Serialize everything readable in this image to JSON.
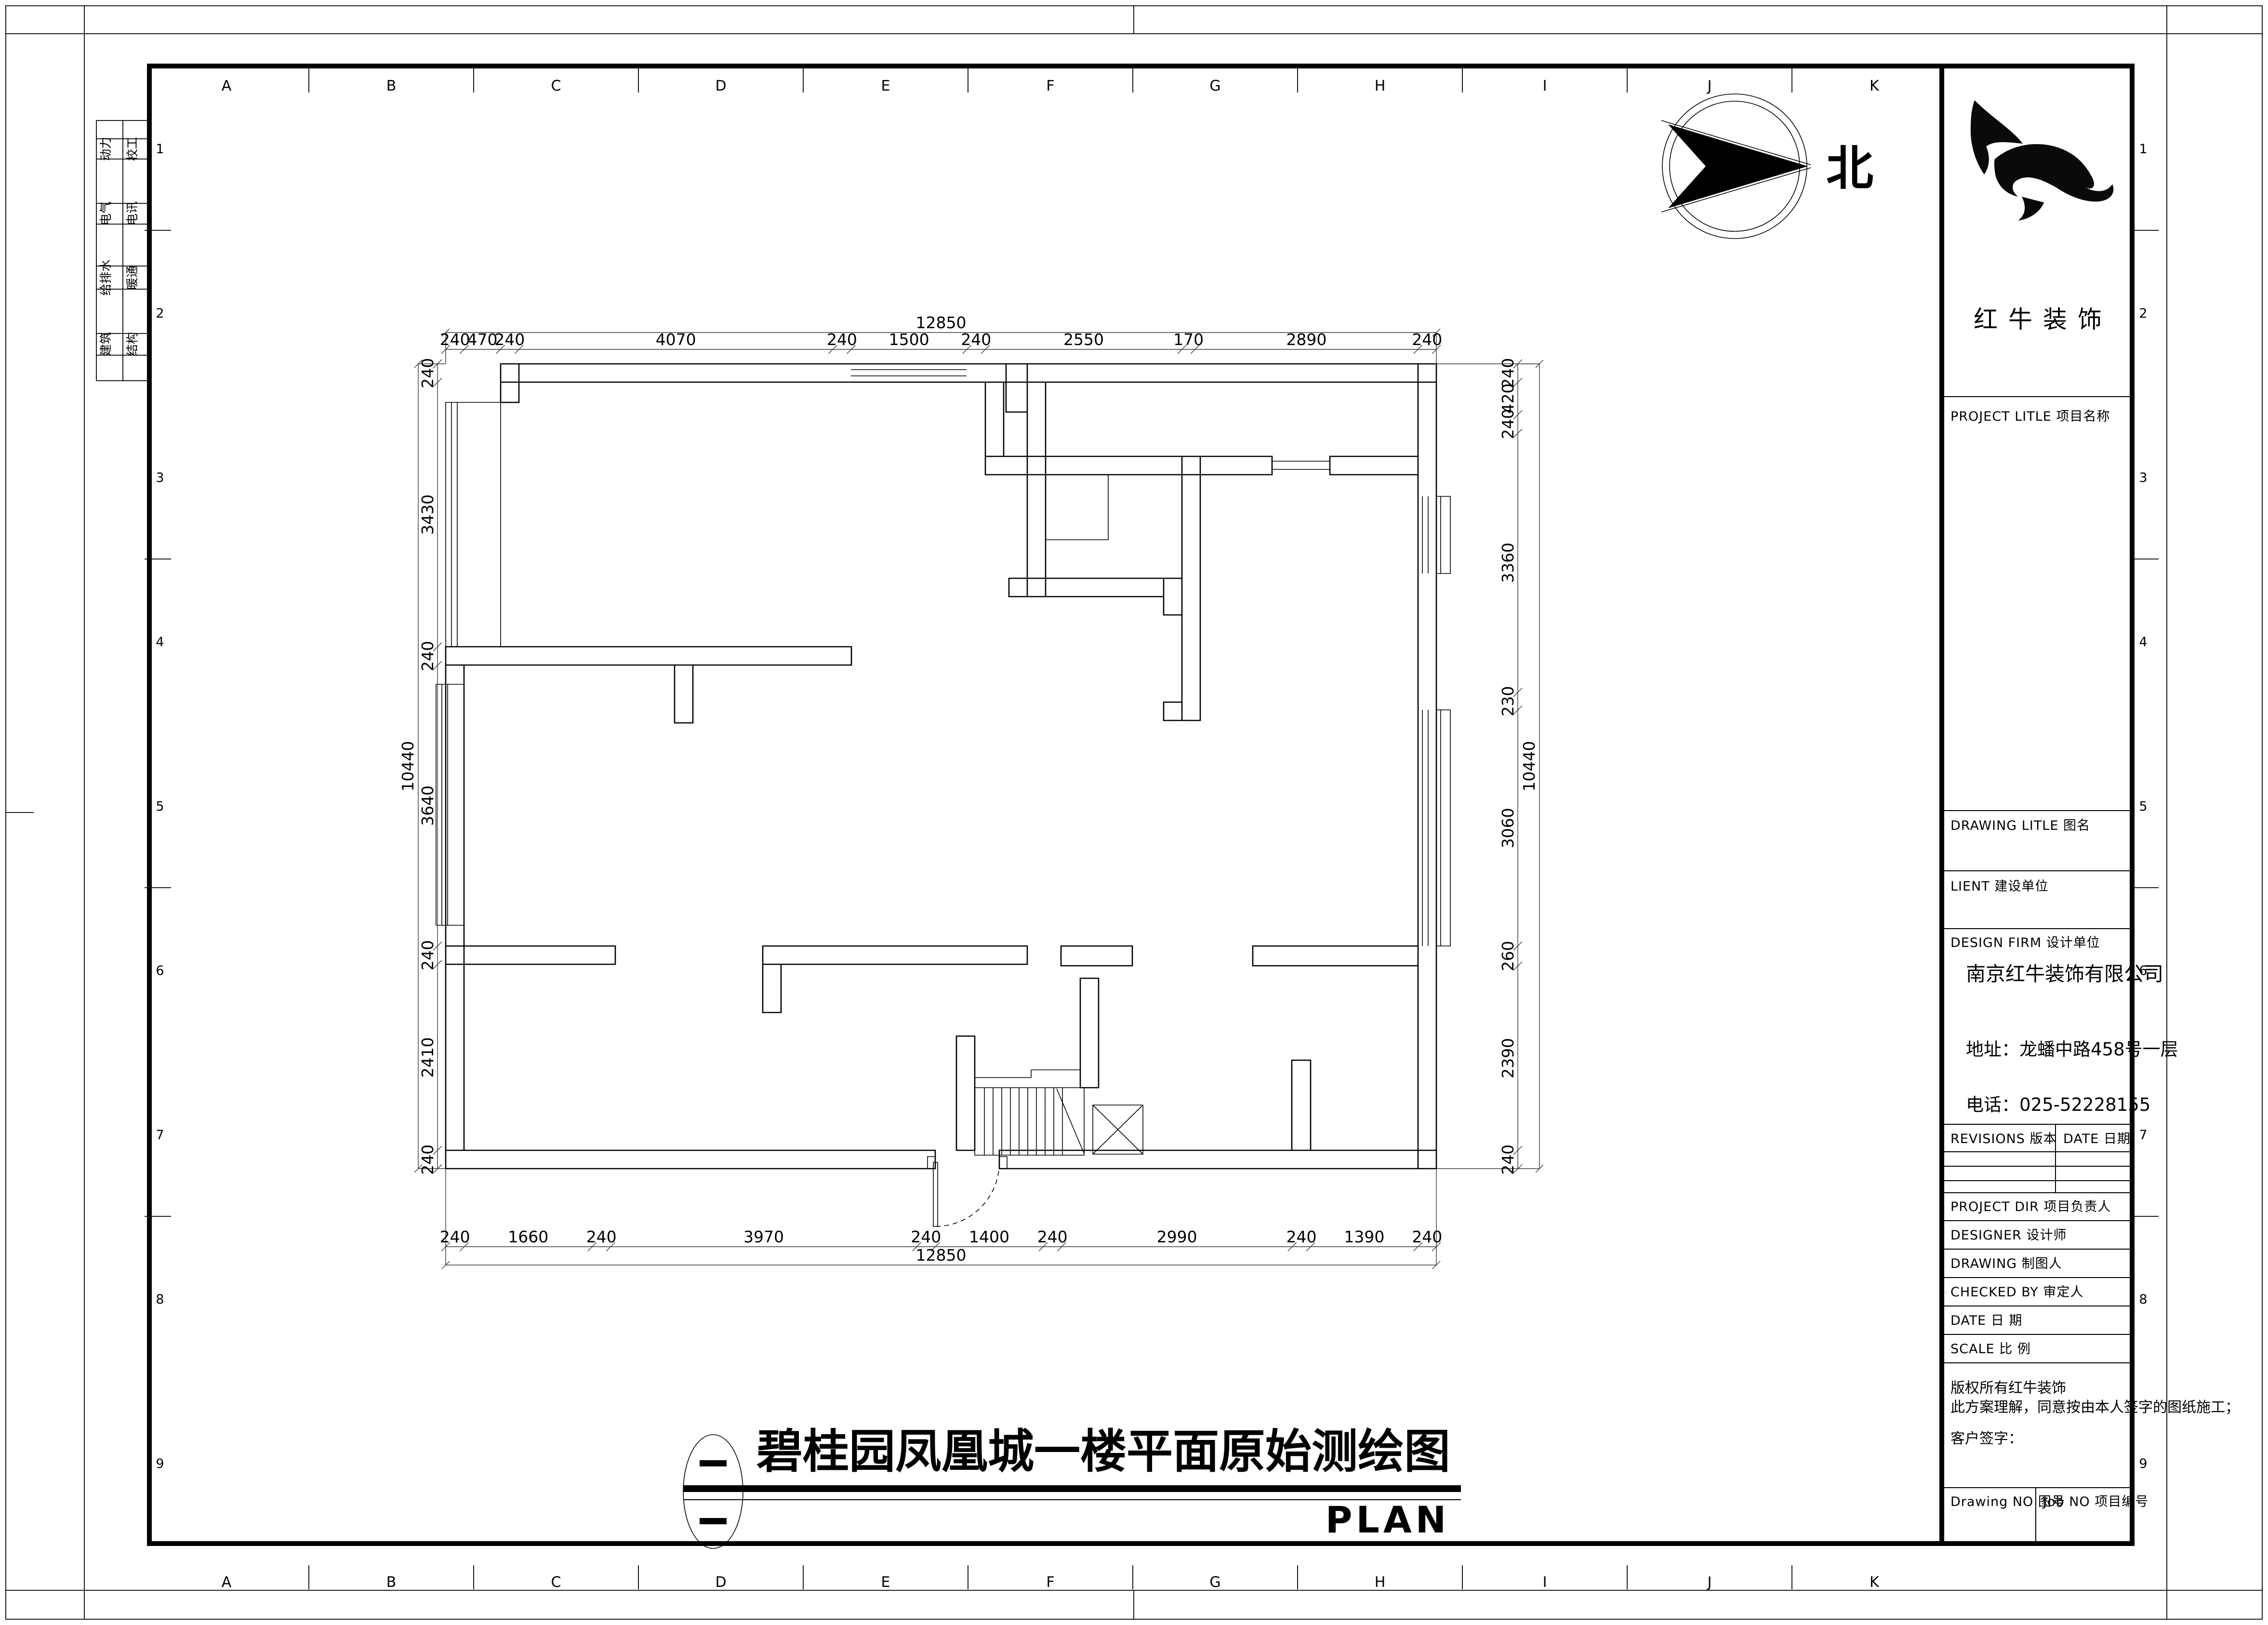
{
  "sheet": {
    "bg": "#ffffff",
    "line_color": "#000000"
  },
  "grid": {
    "letters": [
      "A",
      "B",
      "C",
      "D",
      "E",
      "F",
      "G",
      "H",
      "I",
      "J",
      "K"
    ],
    "numbers": [
      "1",
      "2",
      "3",
      "4",
      "5",
      "6",
      "7",
      "8",
      "9"
    ]
  },
  "disciplines": {
    "col1": [
      "动力",
      "电气",
      "给排水",
      "建筑"
    ],
    "col2": [
      "校工",
      "电讯",
      "暖通",
      "结构"
    ]
  },
  "north": {
    "label": "北"
  },
  "plan": {
    "dims": {
      "top": [
        "240",
        "470",
        "240",
        "4070",
        "240",
        "1500",
        "240",
        "2550",
        "170",
        "2890",
        "240"
      ],
      "bottom": [
        "240",
        "1660",
        "240",
        "3970",
        "240",
        "1400",
        "240",
        "2990",
        "240",
        "1390",
        "240"
      ],
      "left": [
        "240",
        "3430",
        "240",
        "3640",
        "240",
        "2410",
        "240"
      ],
      "right": [
        "240",
        "420",
        "240",
        "3360",
        "230",
        "3060",
        "260",
        "2390",
        "240"
      ],
      "top_total": "12850",
      "bottom_total": "12850",
      "left_total": "10440",
      "right_total": "10440"
    }
  },
  "title": {
    "text": "碧桂园凤凰城一楼平面原始测绘图",
    "plan_label": "PLAN"
  },
  "title_block": {
    "logo_text": "红牛装饰",
    "project_title": "PROJECT LITLE    项目名称",
    "drawing_title": "DRAWING LITLE    图名",
    "client": "LIENT  建设单位",
    "design_firm": "DESIGN FIRM    设计单位",
    "company": "南京红牛装饰有限公司",
    "address": "地址：龙蟠中路458号一层",
    "phone": "电话：025-52228155",
    "revisions_head": "REVISIONS  版本",
    "date_head": "DATE  日期",
    "rows": [
      "PROJECT DIR    项目负责人",
      "DESIGNER         设计师",
      "DRAWING          制图人",
      "CHECKED BY    审定人",
      "DATE                  日  期",
      "SCALE               比  例"
    ],
    "copyright1": "版权所有红牛装饰",
    "copyright2": "此方案理解，同意按由本人签字的图纸施工；",
    "sign": "客户签字：",
    "drawing_no": "Drawing NO  图号",
    "job_no": "Job NO  项目编号"
  }
}
